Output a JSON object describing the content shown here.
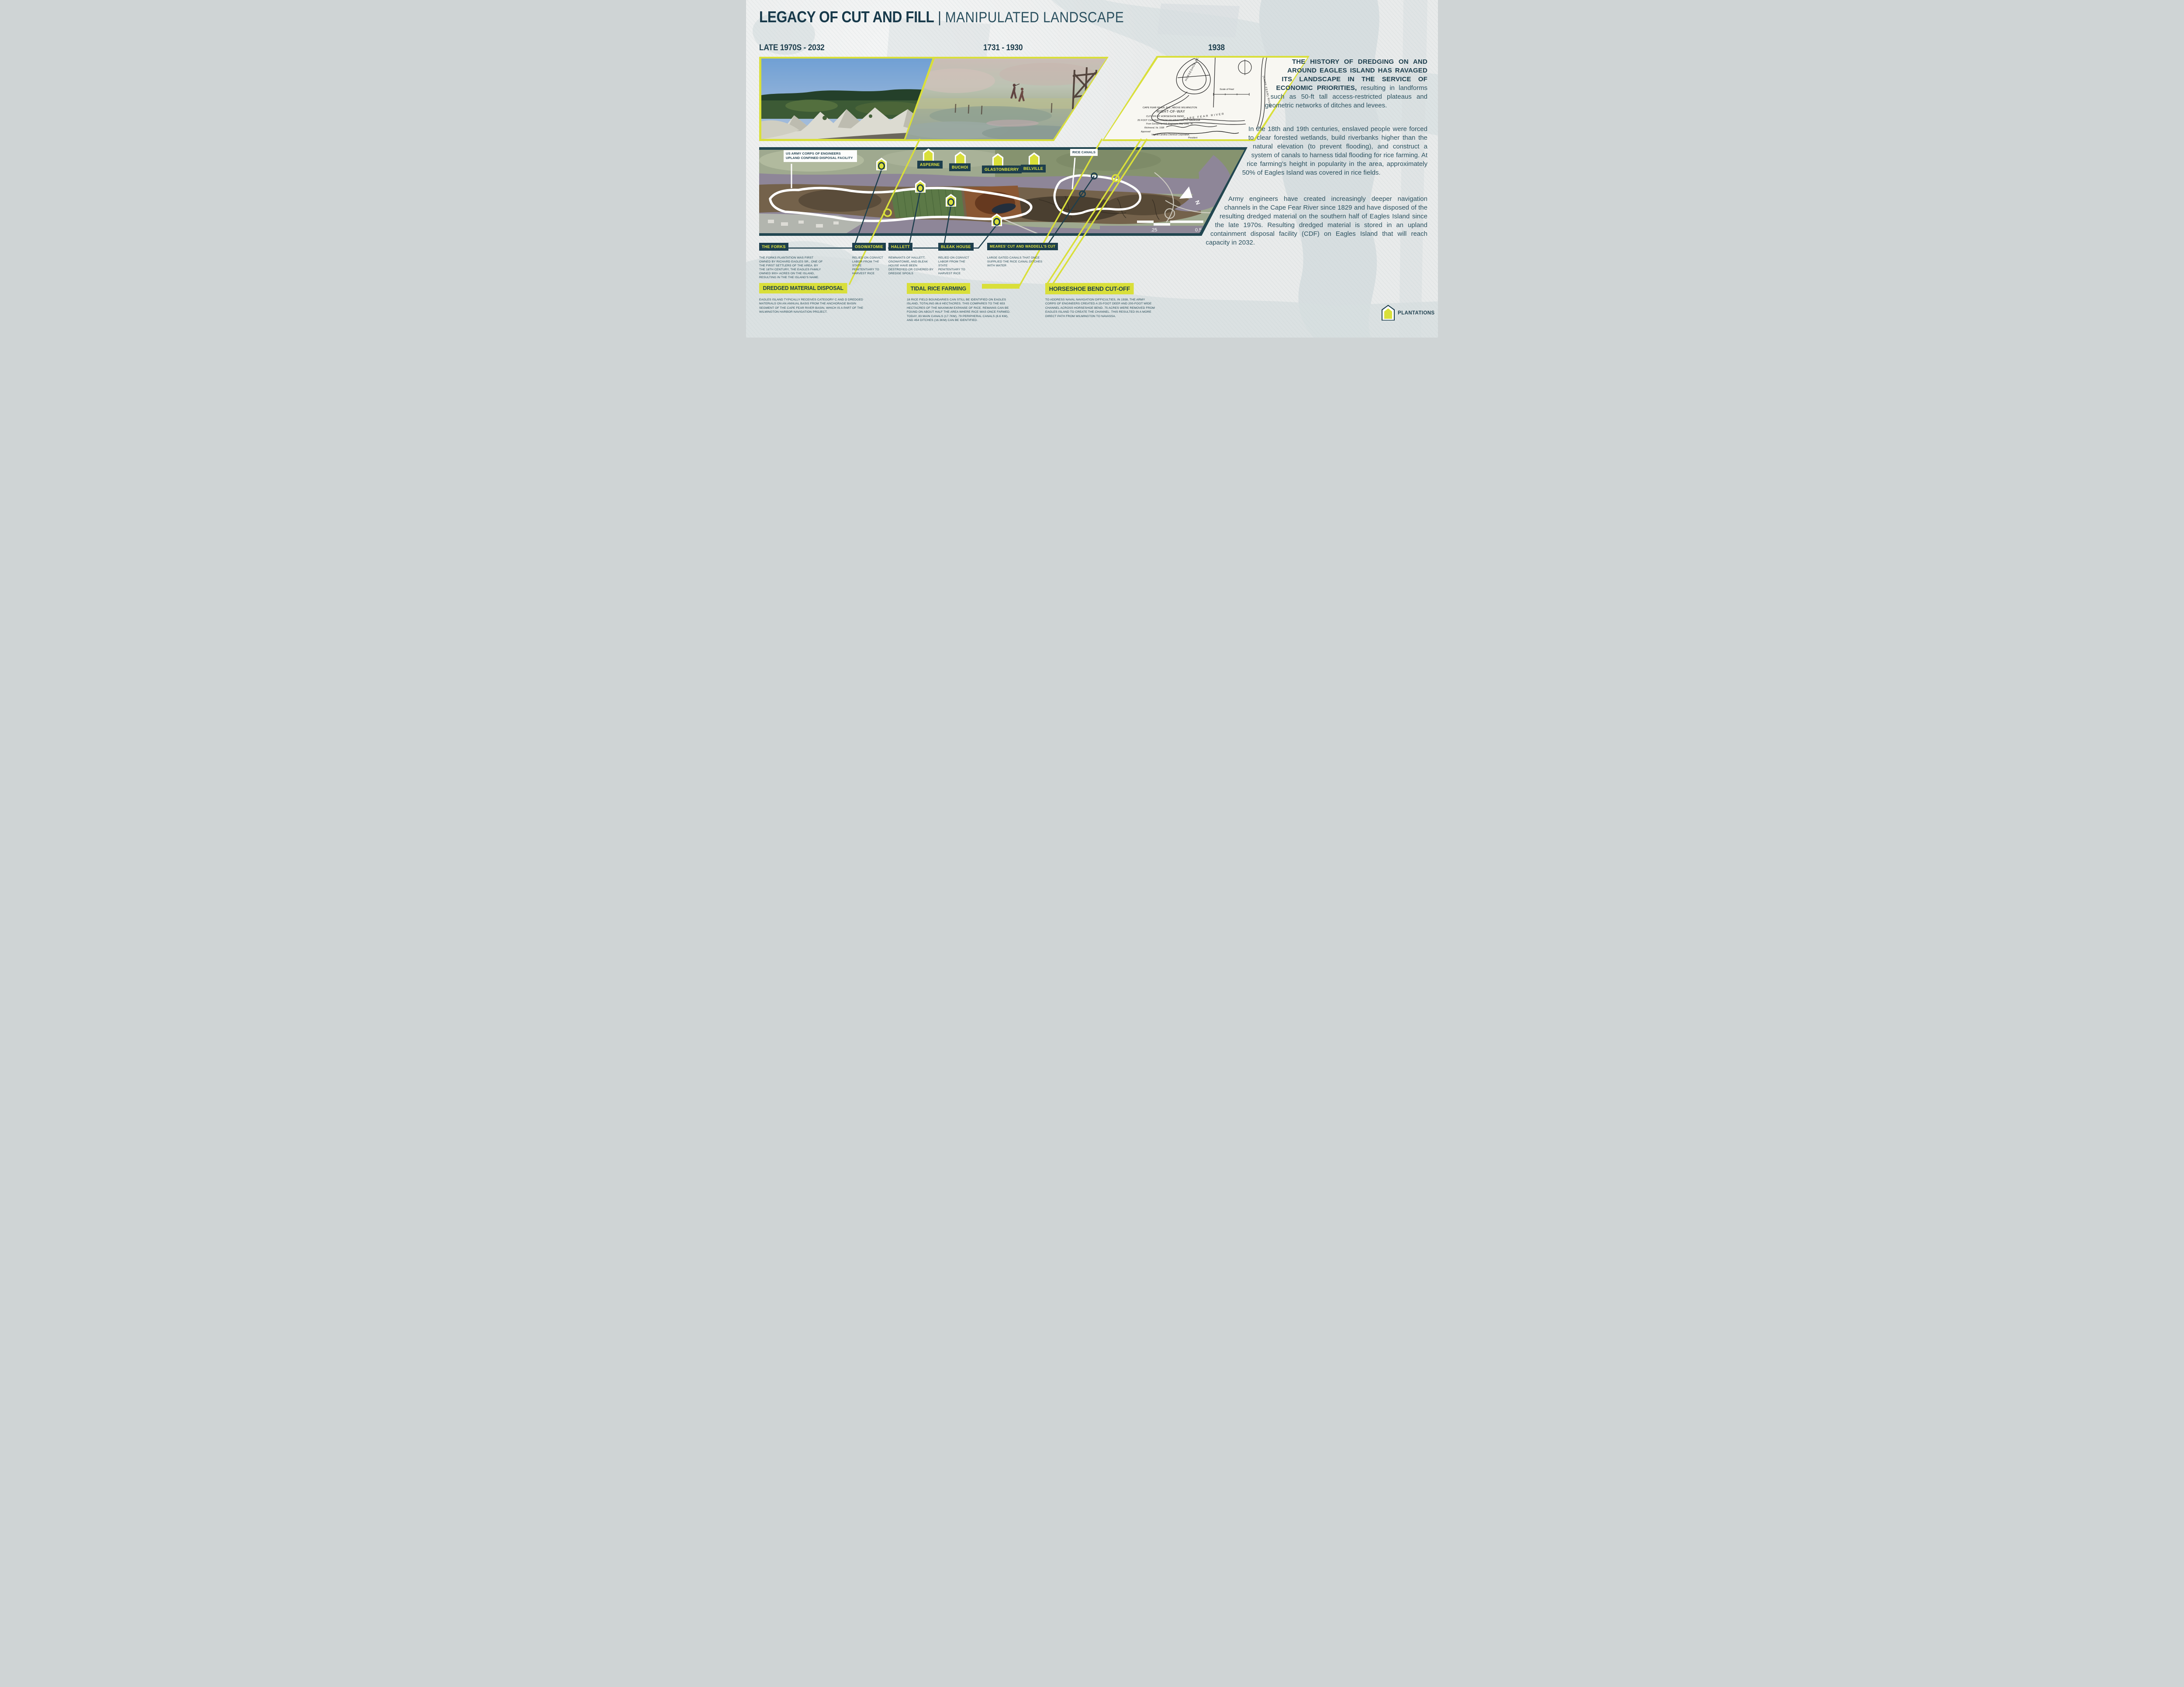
{
  "poster": {
    "title_primary": "LEGACY OF CUT AND FILL",
    "title_separator": "|",
    "title_secondary": "MANIPULATED LANDSCAPE"
  },
  "timeline": {
    "era1": "LATE 1970S - 2032",
    "era2": "1731 - 1930",
    "era3": "1938"
  },
  "narrative": {
    "p1_bold": "THE HISTORY OF DREDGING ON AND AROUND EAGLES ISLAND HAS RAVAGED ITS LANDSCAPE IN THE SERVICE OF ECONOMIC PRIORITIES,",
    "p1_rest": " resulting in landforms such as 50-ft tall access-restricted plateaus and geometric networks of ditches and levees.",
    "p2": "In the 18th and 19th centuries, enslaved people were forced to clear forested wetlands, build riverbanks higher than the natural elevation (to prevent flooding), and construct a system of canals to harness tidal flooding for rice farming. At rice farming’s height in popularity in the area, approximately 50% of Eagles Island was covered in rice fields.",
    "p3": "Army engineers have created increasingly deeper navigation channels in the Cape Fear River since 1829 and have disposed of the resulting dredged material on the southern half of Eagles Island since the late 1970s. Resulting dredged material is stored in an upland containment disposal facility (CDF) on Eagles Island that will reach capacity in 2032."
  },
  "aerial_map": {
    "cdf_label": "US ARMY CORPS OF ENGINEERS UPLAND CONFINED DISPOSAL FACILITY",
    "rice_canals_label": "RICE CANALS",
    "towns": [
      "ASPERNE",
      "BUCHOI",
      "GLASTONBERRY",
      "BELVILLE"
    ],
    "scale_bar": {
      "first": ".25",
      "second": "0.5",
      "unit": "MI"
    },
    "north_label": "N"
  },
  "map1938": {
    "annotations": {
      "horseshoe_bend": "HORSESHOE BEND",
      "cape_fear_river": "CAPE FEAR RIVER",
      "cape_fear_river_vertical": "(CAPE FEAR) RIVER",
      "scale_of_feet": "Scale of Feet"
    },
    "title_block": [
      "CAPE FEAR RIVER, N.C., ABOVE WILMINGTON",
      "RIGHT-OF-WAY",
      "CUT-OFF AT HORSESHOE BEND",
      "25 FOOT CHANNEL FROM WILMINGTON TO NAVASSA",
      "From Surveys by U.S. Engineers, May-June, '36",
      "Richmond, Va. 1938",
      "Approved:",
      "Virginia Carolina Chemical Corporation,",
      "President"
    ]
  },
  "callouts": [
    {
      "name": "THE FORKS",
      "body": "THE FORKS PLANTATION WAS FIRST OWNED BY RICHARD EAGLES SR., ONE OF THE FIRST SETTLERS OF THE AREA. BY THE 18TH CENTURY, THE EAGLES FAMILY OWNED 900+ ACRES ON THE ISLAND, RESULTING IN THE THE ISLAND’S NAME."
    },
    {
      "name": "OSOWATOMIE",
      "body": "RELIED ON CONVICT LABOR FROM THE STATE PENITENTIARY TO HARVEST RICE"
    },
    {
      "name": "HALLETT",
      "body": "REMNANTS OF HALLETT, OSOWATOMIE, AND BLEAK HOUSE HAVE BEEN DESTROYED OR COVERED BY DREDGE SPOILS"
    },
    {
      "name": "BLEAK HOUSE",
      "body": "RELIED ON CONVICT LABOR FROM THE STATE PENITENTIARY TO HARVEST RICE"
    },
    {
      "name": "MEARES’ CUT AND WADDELL’S CUT",
      "body": "LARGE GATED CANALS THAT ONCE SUPPLIED THE RICE CANAL DITCHES WITH WATER"
    }
  ],
  "sections": [
    {
      "heading": "DREDGED MATERIAL DISPOSAL",
      "body": "EAGLES ISLAND TYPICALLY RECEIVES CATEGORY C AND D DREDGED MATERIALS ON AN ANNUAL BASIS FROM THE ANCHORAGE BASIN SEGMENT OF THE CAPE FEAR RIVER BASIN, WHICH IS A PART OF THE WILMINGTON HARBOR NAVIGATION PROJECT."
    },
    {
      "heading": "TIDAL RICE FARMING",
      "body": "18 RICE FIELD BOUNDARIES CAN STILL BE IDENTIFIED ON EAGLES ISLAND, TOTALING 86.6 HECTACRES. THIS COMPARES TO THE 653 HECTACRES OF THE MAXIMUM EXPANSE OF RICE. REMAINS CAN BE FOUND ON ABOUT HALF THE AREA WHERE RICE WAS ONCE FARMED. TODAY, 83 MAIN CANALS (17.7KM), 79 PERIPHERAL CANALS (6.6 KM), AND 454 DITCHES (16.3KM) CAN BE IDENTIFIED."
    },
    {
      "heading": "HORSESHOE BEND CUT-OFF",
      "body": "TO ADDRESS NAVAL NAVIGATION DIFFICULTIES, IN 1938, THE ARMY CORPS OF ENGINEERS CREATED A 25-FOOT DEEP AND 200-FOOT WIDE CHANNEL ACROSS HORSESHOE BEND. 75 ACRES WERE REMOVED FROM EAGLES ISLAND TO CREATE THE CHANNEL. THIS RESULTED IN A MORE DIRECT PATH FROM WILMINGTON TO NAVASSA."
    }
  ],
  "legend": {
    "plantations": "PLANTATIONS"
  },
  "colors": {
    "teal": "#1d3e4d",
    "yellow": "#d9df3a",
    "yellow_text": "#e8e93f",
    "paper": "#e9ebeb"
  }
}
